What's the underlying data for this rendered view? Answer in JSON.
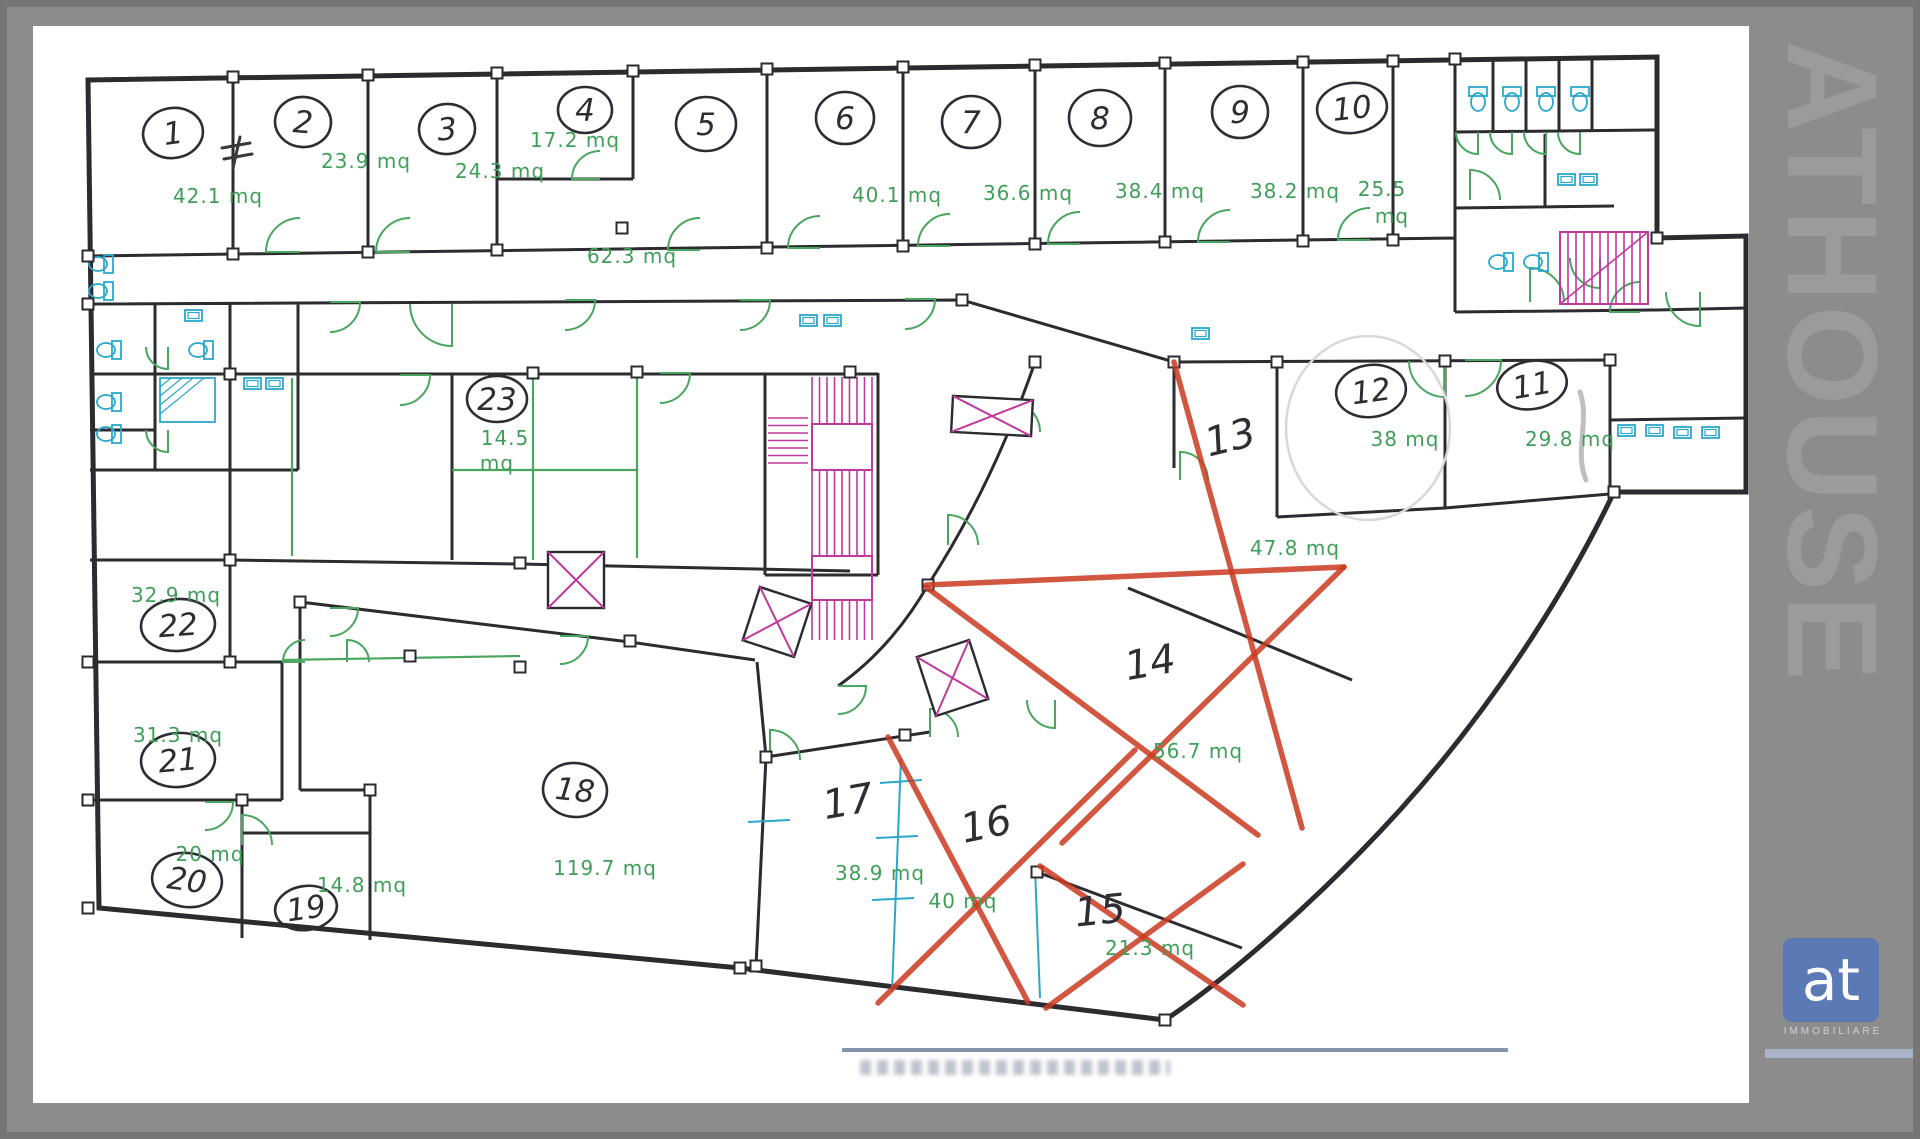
{
  "window": {
    "watermark": "ATHOUSE"
  },
  "logo": {
    "text": "at",
    "subtext": "IMMOBILIARE",
    "bg": "#5a79b5"
  },
  "plan": {
    "unit": "mq",
    "colors": {
      "wall": "#2b2b30",
      "area_text": "#3f9f58",
      "door_arc": "#4aa65e",
      "fixture": "#2aa7cc",
      "stair": "#c0399c",
      "red_mark": "#cb3a20",
      "ink": "#2d2d33"
    },
    "rooms": [
      {
        "id": "1",
        "circled": true,
        "nx": 173,
        "ny": 133,
        "rx": 30,
        "ry": 25,
        "rot": -8,
        "area": "42.1 mq",
        "ax": 218,
        "ay": 196
      },
      {
        "id": "2",
        "circled": true,
        "nx": 303,
        "ny": 122,
        "rx": 28,
        "ry": 25,
        "rot": 5,
        "area": "23.9 mq",
        "ax": 366,
        "ay": 161
      },
      {
        "id": "3",
        "circled": true,
        "nx": 447,
        "ny": 129,
        "rx": 28,
        "ry": 25,
        "rot": -5,
        "area": "24.3 mq",
        "ax": 500,
        "ay": 171
      },
      {
        "id": "4",
        "circled": true,
        "nx": 585,
        "ny": 110,
        "rx": 27,
        "ry": 23,
        "rot": 0,
        "area": "17.2 mq",
        "ax": 575,
        "ay": 140
      },
      {
        "id": "5",
        "circled": true,
        "nx": 706,
        "ny": 124,
        "rx": 30,
        "ry": 27,
        "rot": 0,
        "area": "62.3 mq",
        "ax": 632,
        "ay": 256
      },
      {
        "id": "6",
        "circled": true,
        "nx": 845,
        "ny": 118,
        "rx": 29,
        "ry": 26,
        "rot": 0,
        "area": "40.1 mq",
        "ax": 897,
        "ay": 195
      },
      {
        "id": "7",
        "circled": true,
        "nx": 971,
        "ny": 122,
        "rx": 29,
        "ry": 26,
        "rot": 0,
        "area": "36.6 mq",
        "ax": 1028,
        "ay": 193
      },
      {
        "id": "8",
        "circled": true,
        "nx": 1100,
        "ny": 118,
        "rx": 31,
        "ry": 28,
        "rot": 0,
        "area": "38.4 mq",
        "ax": 1160,
        "ay": 191
      },
      {
        "id": "9",
        "circled": true,
        "nx": 1240,
        "ny": 112,
        "rx": 28,
        "ry": 26,
        "rot": 0,
        "area": "38.2 mq",
        "ax": 1295,
        "ay": 191
      },
      {
        "id": "10",
        "circled": true,
        "nx": 1352,
        "ny": 108,
        "rx": 35,
        "ry": 25,
        "rot": -6,
        "area": "25.5",
        "ax": 1382,
        "ay": 189,
        "area2": "mq",
        "a2x": 1392,
        "a2y": 216
      },
      {
        "id": "11",
        "circled": true,
        "nx": 1532,
        "ny": 385,
        "rx": 35,
        "ry": 24,
        "rot": -10,
        "area": "29.8 mq",
        "ax": 1570,
        "ay": 439
      },
      {
        "id": "12",
        "circled": true,
        "nx": 1371,
        "ny": 391,
        "rx": 35,
        "ry": 26,
        "rot": -8,
        "area": "38 mq",
        "ax": 1405,
        "ay": 439
      },
      {
        "id": "13",
        "circled": false,
        "nx": 1230,
        "ny": 437,
        "rot": -14,
        "area": "47.8 mq",
        "ax": 1295,
        "ay": 548
      },
      {
        "id": "14",
        "circled": false,
        "nx": 1150,
        "ny": 662,
        "rot": -10,
        "area": "56.7 mq",
        "ax": 1198,
        "ay": 751
      },
      {
        "id": "15",
        "circled": false,
        "nx": 1100,
        "ny": 910,
        "rot": -6,
        "area": "21.3 mq",
        "ax": 1150,
        "ay": 948
      },
      {
        "id": "16",
        "circled": false,
        "nx": 986,
        "ny": 824,
        "rot": -12,
        "area": "40 mq",
        "ax": 963,
        "ay": 901
      },
      {
        "id": "17",
        "circled": false,
        "nx": 848,
        "ny": 801,
        "rot": -10,
        "area": "38.9 mq",
        "ax": 880,
        "ay": 873
      },
      {
        "id": "18",
        "circled": true,
        "nx": 575,
        "ny": 790,
        "rx": 32,
        "ry": 27,
        "rot": 6,
        "area": "119.7 mq",
        "ax": 605,
        "ay": 868
      },
      {
        "id": "19",
        "circled": true,
        "nx": 306,
        "ny": 908,
        "rx": 31,
        "ry": 22,
        "rot": -8,
        "area": "14.8 mq",
        "ax": 362,
        "ay": 885
      },
      {
        "id": "20",
        "circled": true,
        "nx": 187,
        "ny": 880,
        "rx": 35,
        "ry": 27,
        "rot": 8,
        "area": "20 mq",
        "ax": 210,
        "ay": 854
      },
      {
        "id": "21",
        "circled": true,
        "nx": 178,
        "ny": 760,
        "rx": 37,
        "ry": 27,
        "rot": -5,
        "area": "31.3 mq",
        "ax": 178,
        "ay": 735
      },
      {
        "id": "22",
        "circled": true,
        "nx": 178,
        "ny": 625,
        "rx": 37,
        "ry": 26,
        "rot": -4,
        "area": "32.9 mq",
        "ax": 176,
        "ay": 595
      },
      {
        "id": "23",
        "circled": true,
        "nx": 497,
        "ny": 399,
        "rx": 30,
        "ry": 23,
        "rot": 0,
        "area": "14.5",
        "ax": 505,
        "ay": 438,
        "area2": "mq",
        "a2x": 497,
        "a2y": 463
      }
    ],
    "marks": [
      [
        1174,
        362,
        1302,
        828
      ],
      [
        926,
        585,
        1344,
        567
      ],
      [
        1344,
        567,
        1062,
        843
      ],
      [
        926,
        587,
        1258,
        835
      ],
      [
        888,
        737,
        1028,
        1002
      ],
      [
        1135,
        750,
        878,
        1003
      ],
      [
        1040,
        866,
        1243,
        1005
      ],
      [
        1243,
        864,
        1046,
        1008
      ]
    ]
  }
}
